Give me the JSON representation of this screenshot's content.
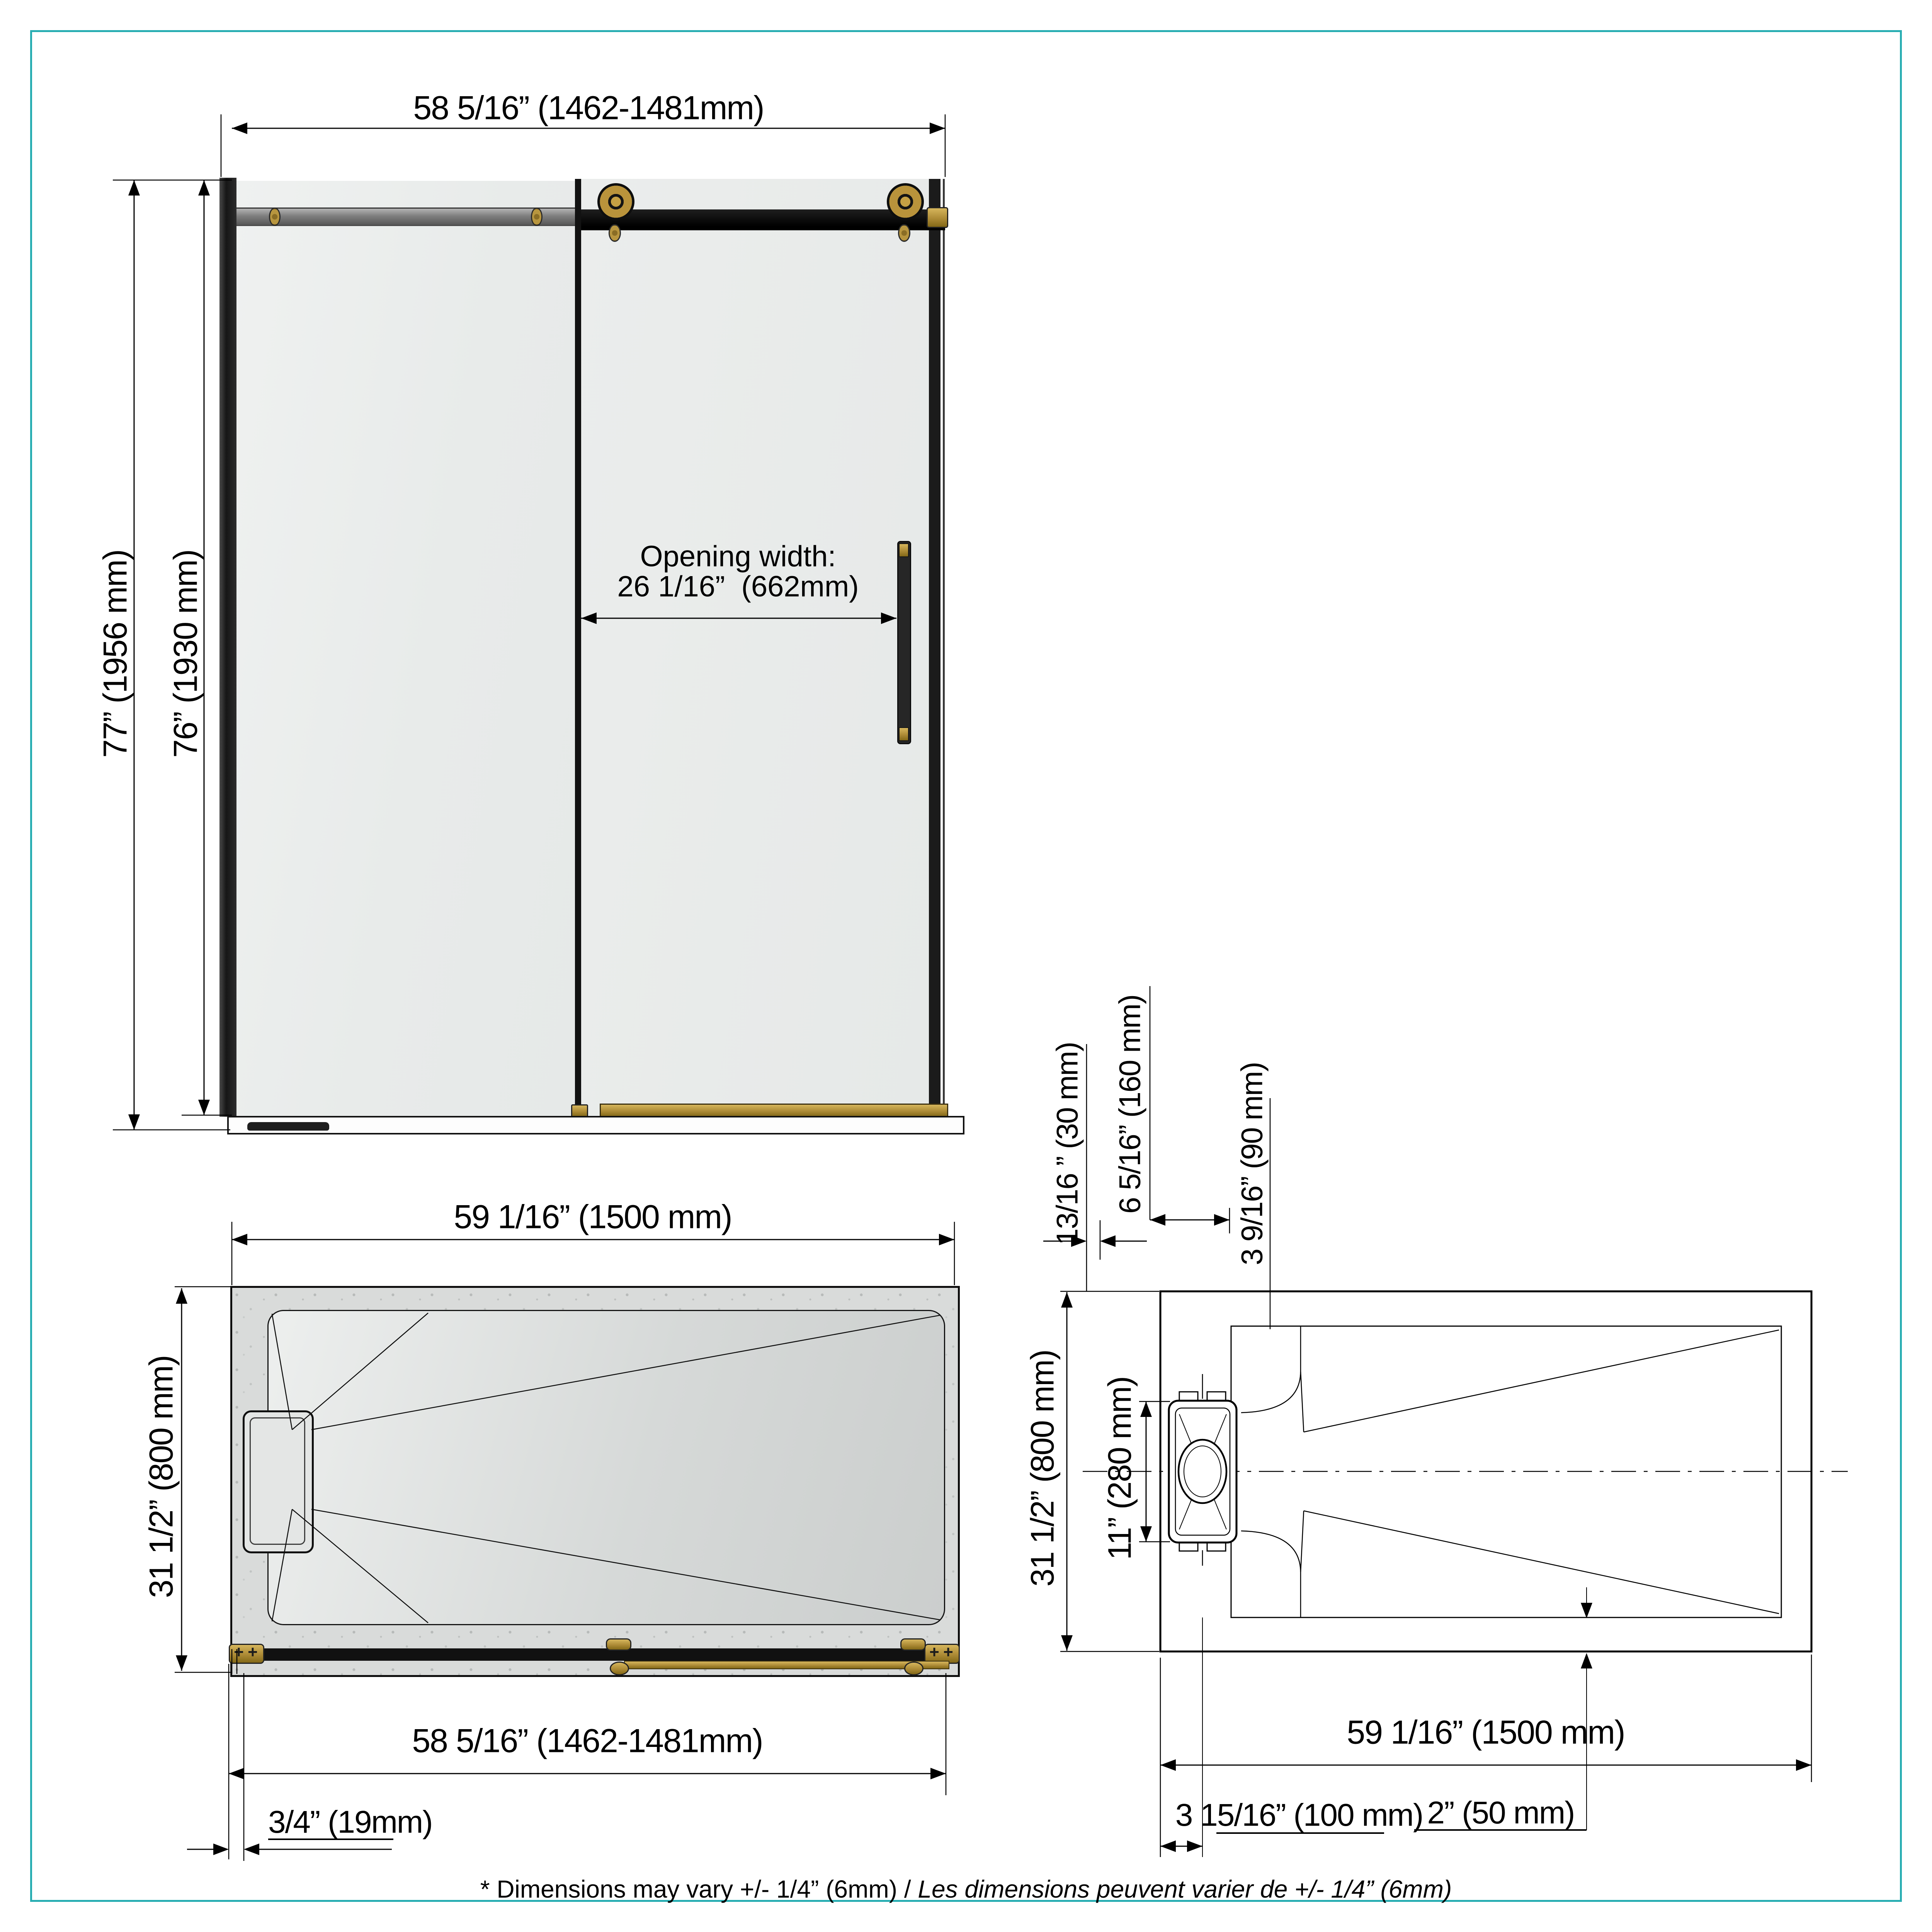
{
  "front_view": {
    "width_label": "58 5/16” (1462-1481mm)",
    "height_total_label": "77” (1956 mm)",
    "height_door_label": "76” (1930 mm)",
    "opening_title": "Opening width:",
    "opening_value": "26 1/16”  (662mm)"
  },
  "base_plan_view": {
    "width_top_label": "59 1/16” (1500 mm)",
    "depth_label": "31 1/2” (800 mm)",
    "width_bottom_label": "58 5/16” (1462-1481mm)",
    "lip_label": "3/4” (19mm)"
  },
  "drain_plan_view": {
    "offset_wall_label": "13/16 ” (30 mm)",
    "drain_width_label": "6 5/16” (160 mm)",
    "drain_center_offset_label": "3 9/16” (90 mm)",
    "depth_label": "31 1/2” (800 mm)",
    "drain_length_label": "11” (280 mm)",
    "width_label": "59 1/16” (1500 mm)",
    "drain_offset_label": "3 15/16” (100 mm)",
    "edge_offset_label": "2” (50 mm)"
  },
  "footnote": {
    "en": "* Dimensions may vary +/- 1/4” (6mm) / ",
    "fr": "Les dimensions peuvent varier de +/- 1/4” (6mm)"
  },
  "colors": {
    "accent_teal": "#28ADB2",
    "brass": "#AD8B36",
    "line_black": "#000000",
    "glass_gray": "#ECEFEE",
    "base_gray": "#D9DBDA"
  }
}
